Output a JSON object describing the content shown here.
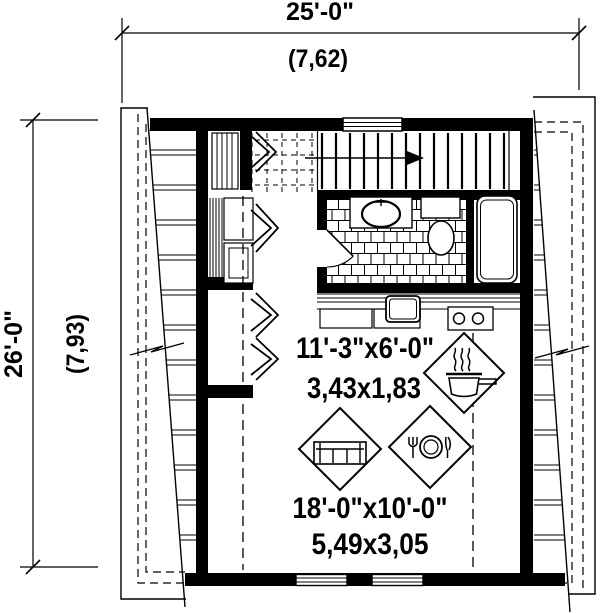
{
  "page": {
    "background": "#ffffff",
    "line_color": "#000000"
  },
  "dimensions": {
    "top": {
      "imperial": "25'-0\"",
      "metric": "(7,62)"
    },
    "left": {
      "imperial": "26'-0\"",
      "metric": "(7,93)"
    }
  },
  "rooms": {
    "kitchen": {
      "imperial": "11'-3\"x6'-0\"",
      "metric": "3,43x1,83",
      "icon": "cooking-pot-icon"
    },
    "living_dining": {
      "imperial": "18'-0\"x10'-0\"",
      "metric": "5,49x3,05",
      "icons": [
        "sofa-icon",
        "dining-plate-icon"
      ]
    }
  }
}
